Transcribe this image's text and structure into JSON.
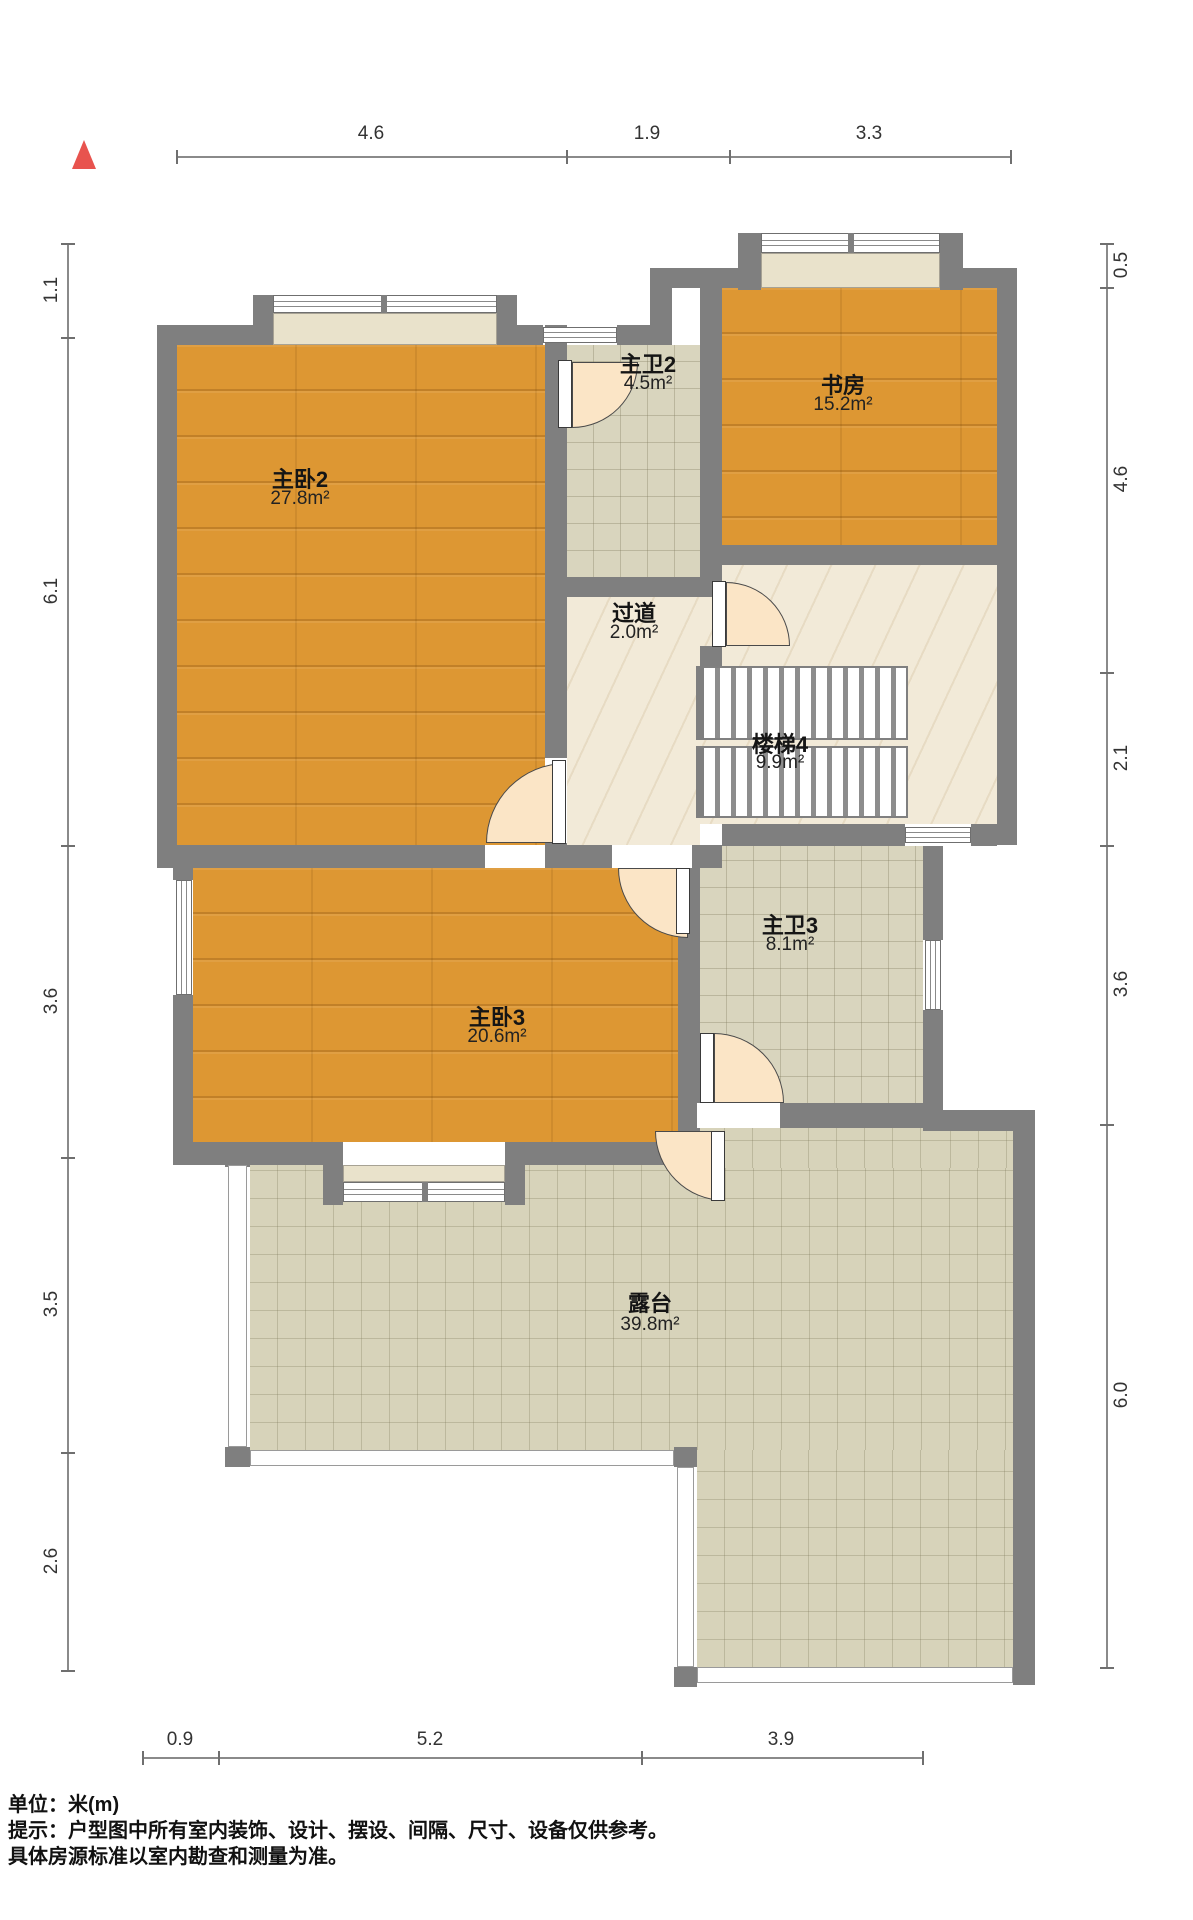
{
  "title": "户型图 (floor plan)",
  "unit_note": "单位：米(m)",
  "disclaimer_line1": "提示：户型图中所有室内装饰、设计、摆设、间隔、尺寸、设备仅供参考。",
  "disclaimer_line2": "具体房源标准以室内勘查和测量为准。",
  "compass": {
    "icon": "north-triangle",
    "color": "#e8534e"
  },
  "rooms": [
    {
      "name": "主卧2",
      "area": "27.8m²"
    },
    {
      "name": "主卫2",
      "area": "4.5m²"
    },
    {
      "name": "书房",
      "area": "15.2m²"
    },
    {
      "name": "过道",
      "area": "2.0m²"
    },
    {
      "name": "楼梯4",
      "area": "9.9m²"
    },
    {
      "name": "主卧3",
      "area": "20.6m²"
    },
    {
      "name": "主卫3",
      "area": "8.1m²"
    },
    {
      "name": "露台",
      "area": "39.8m²"
    }
  ],
  "dimensions": {
    "top": [
      "4.6",
      "1.9",
      "3.3"
    ],
    "left": [
      "1.1",
      "6.1",
      "3.6",
      "3.5",
      "2.6"
    ],
    "right": [
      "0.5",
      "4.6",
      "2.1",
      "3.6",
      "6.0"
    ],
    "bottom": [
      "0.9",
      "5.2",
      "3.9"
    ]
  },
  "colors": {
    "wall": "#7f7f7f",
    "wood_floor": "#dd9733",
    "bath_tile": "#d9d5be",
    "hall_marble": "#f2ead8",
    "terrace_tile": "#d7d3ba",
    "door_swing": "#fbe5c6",
    "compass_red": "#e8534e"
  }
}
